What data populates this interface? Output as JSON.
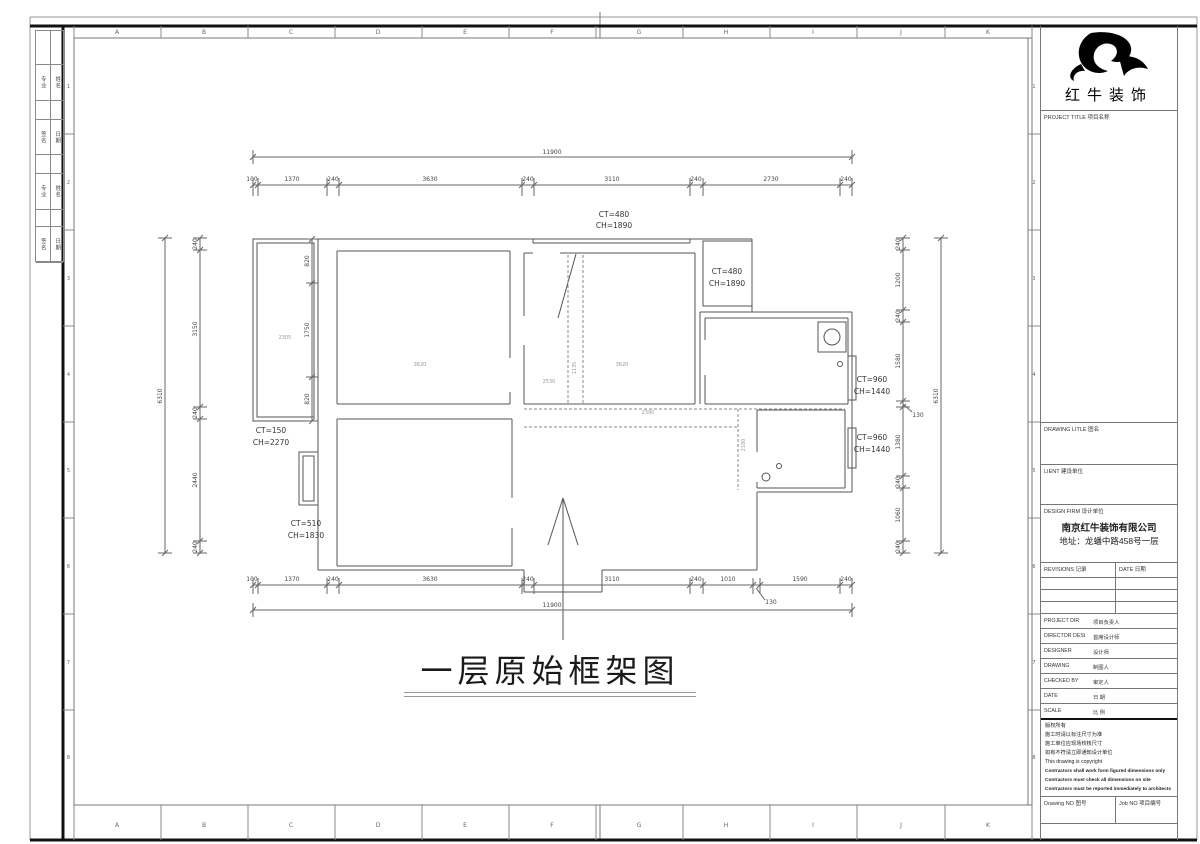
{
  "sheet": {
    "grid_letters": [
      "A",
      "B",
      "C",
      "D",
      "E",
      "F",
      "G",
      "H",
      "I",
      "J",
      "K"
    ],
    "grid_numbers": [
      "1",
      "2",
      "3",
      "4",
      "5",
      "6",
      "7",
      "8"
    ],
    "signature_strip": {
      "rows": [
        {
          "c1": "专业",
          "c2": "姓名"
        },
        {
          "c1": "签名",
          "c2": "日期"
        },
        {
          "c1": "专业",
          "c2": "姓名"
        },
        {
          "c1": "签名",
          "c2": "日期"
        }
      ]
    }
  },
  "title_block": {
    "logo_text": "红牛装饰",
    "project_title_label": "PROJECT TITLE  项目名称",
    "drawing_title_label": "DRAWING LITLE  图名",
    "client_label": "LIENT  建设单位",
    "design_firm_label": "DESIGN FIRM  设计单位",
    "firm_name": "南京红牛装饰有限公司",
    "firm_address": "地址：龙蟠中路458号一层",
    "revisions_label": "REVISIONS  记录",
    "revisions_date_label": "DATE  日期",
    "personnel_rows": [
      {
        "en": "PROJECT DIR",
        "cn": "项目负责人"
      },
      {
        "en": "DIRECTOR DESI",
        "cn": "首席设计师"
      },
      {
        "en": "DESIGNER",
        "cn": "设计师"
      },
      {
        "en": "DRAWING",
        "cn": "制图人"
      },
      {
        "en": "CHECKED BY",
        "cn": "审定人"
      },
      {
        "en": "DATE",
        "cn": "日  期"
      },
      {
        "en": "SCALE",
        "cn": "比  例"
      }
    ],
    "copyright_lines": [
      "版权所有",
      "施工时请以标注尺寸为准",
      "施工单位应现场校核尺寸",
      "如有不符请立即通知设计单位",
      "This drawing is copyright",
      "Contractors shall work form figured dimensions only",
      "Contractors must check all dimensions on site",
      "Contractors must be reported immediately to architects"
    ],
    "drawing_no_label": "Drawing NO  图号",
    "job_no_label": "Job NO  项目编号"
  },
  "plan": {
    "title": "一层原始框架图",
    "dims": {
      "top_total": "11900",
      "top_segments": [
        "100",
        "1370",
        "240",
        "3630",
        "240",
        "3110",
        "240",
        "2730",
        "240"
      ],
      "bottom_segments": [
        "100",
        "1370",
        "240",
        "3630",
        "240",
        "3110",
        "240",
        "1010",
        "130",
        "1590",
        "240"
      ],
      "bottom_total": "11900",
      "left_segments": [
        "240",
        "3150",
        "240",
        "2440",
        "240"
      ],
      "left_total": "6310",
      "right_segments": [
        "240",
        "1200",
        "240",
        "1580",
        "130",
        "1380",
        "240",
        "1060",
        "240"
      ],
      "right_total": "6310",
      "balcony_segments": [
        "820",
        "1750",
        "820"
      ]
    },
    "window_labels": {
      "top": {
        "ct": "CT=480",
        "ch": "CH=1890"
      },
      "top_right_room": {
        "ct": "CT=480",
        "ch": "CH=1890"
      },
      "right_upper": {
        "ct": "CT=960",
        "ch": "CH=1440"
      },
      "right_lower": {
        "ct": "CT=960",
        "ch": "CH=1440"
      },
      "left_balcony": {
        "ct": "CT=150",
        "ch": "CH=2270"
      },
      "left_lower": {
        "ct": "CT=510",
        "ch": "CH=1830"
      }
    },
    "room_annotations": {
      "balcony": "2305",
      "room_top_left": "3620",
      "room_top_middle": "3620",
      "hall_left": "2530",
      "hall_gap": "1135",
      "corridor_h": "2390",
      "corridor_v": "2180"
    }
  }
}
